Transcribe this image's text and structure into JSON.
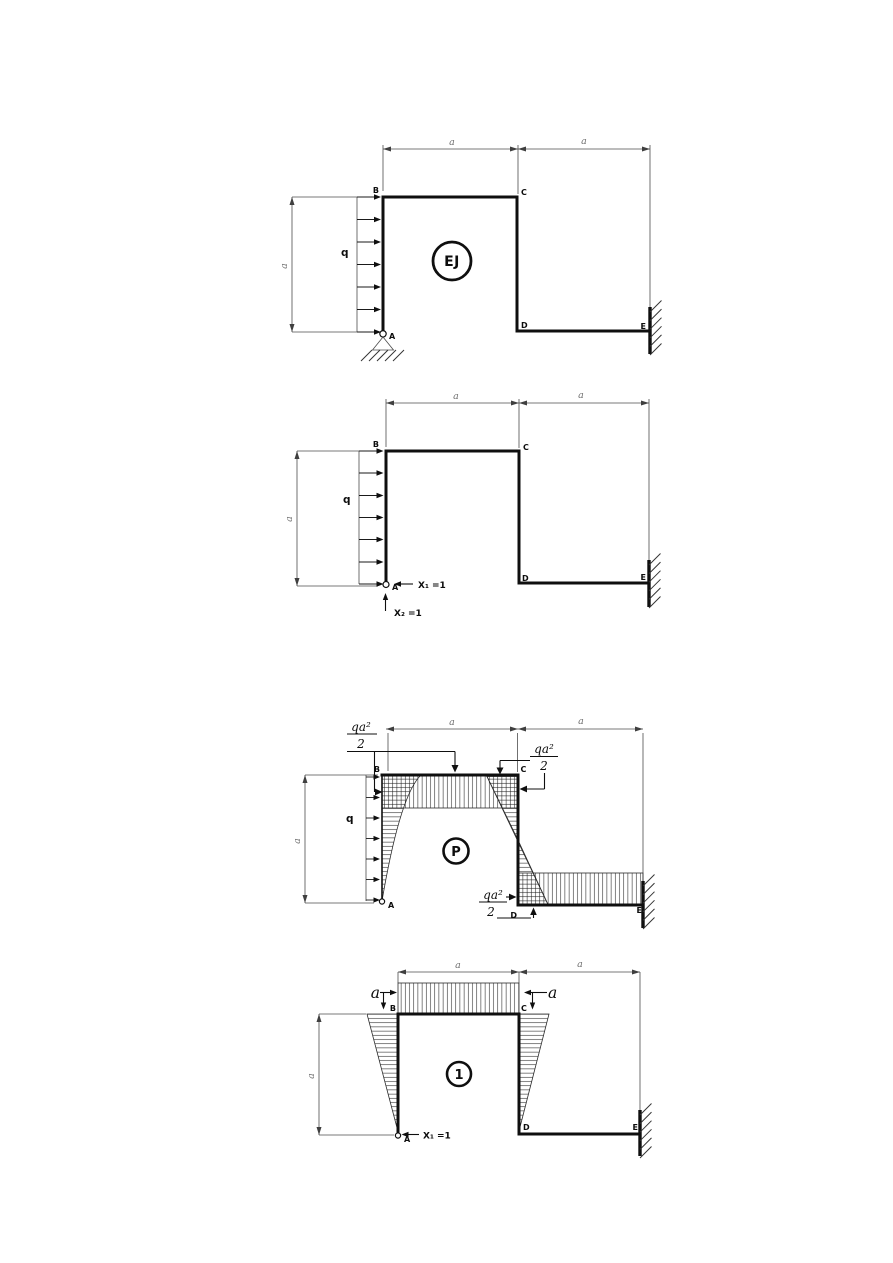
{
  "colors": {
    "ink": "#0f0f0f",
    "dim_line": "#4c4c4c",
    "dim_text": "#6e6e6e",
    "background": "#ffffff"
  },
  "fig_system": {
    "circle_label": "EJ",
    "nodes": {
      "A": "A",
      "B": "B",
      "C": "C",
      "D": "D",
      "E": "E"
    },
    "load_label": "q",
    "dims": {
      "top_left": "a",
      "top_right": "a",
      "left": "a"
    }
  },
  "fig_primary": {
    "nodes": {
      "A": "A",
      "B": "B",
      "C": "C",
      "D": "D",
      "E": "E"
    },
    "load_label": "q",
    "dims": {
      "top_left": "a",
      "top_right": "a",
      "left": "a"
    },
    "redundants": {
      "x1": "X₁ =1",
      "x2": "X₂ =1"
    }
  },
  "fig_mp": {
    "circle_label": "P",
    "nodes": {
      "A": "A",
      "B": "B",
      "C": "C",
      "D": "D",
      "E": "E"
    },
    "load_label": "q",
    "dims": {
      "top_left": "a",
      "top_right": "a",
      "left": "a"
    },
    "moment_values": {
      "at_b": {
        "num": "qa²",
        "den": "2"
      },
      "at_c": {
        "num": "qa²",
        "den": "2"
      },
      "at_d": {
        "num": "qa²",
        "den": "2"
      }
    }
  },
  "fig_m1": {
    "circle_label": "1",
    "nodes": {
      "A": "A",
      "B": "B",
      "C": "C",
      "D": "D",
      "E": "E"
    },
    "dims": {
      "top_left": "a",
      "top_right": "a",
      "left": "a"
    },
    "ordinates": {
      "at_b": "a",
      "at_c": "a"
    },
    "redundants": {
      "x1": "X₁ =1"
    }
  }
}
